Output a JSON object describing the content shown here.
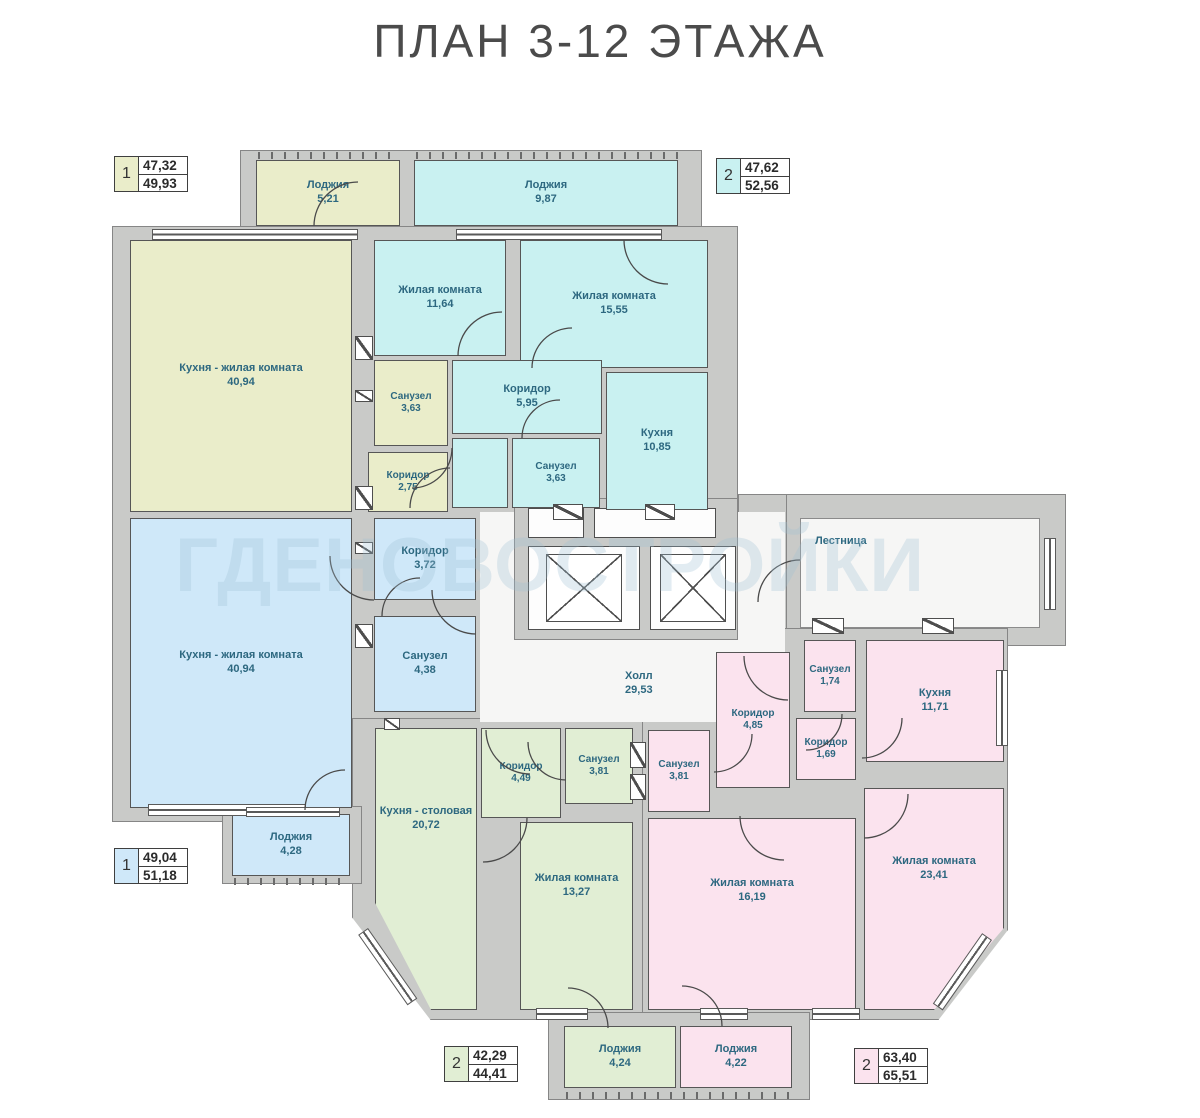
{
  "title": "ПЛАН 3-12 ЭТАЖА",
  "watermark": "ГДЕНОВОСТРОЙКИ",
  "palette": {
    "wall": "#c9cac8",
    "apartment_1_top": "#eaedca",
    "apartment_2_top": "#c9f1f1",
    "apartment_1_bottom": "#cfe8f9",
    "apartment_2_bottom_left": "#e1eed4",
    "apartment_2_bottom_right": "#fbe3ee",
    "room_label": "#2d6880",
    "title_color": "#4b4b4b"
  },
  "badges": [
    {
      "num": "1",
      "area_top": "47,32",
      "area_bottom": "49,93"
    },
    {
      "num": "2",
      "area_top": "47,62",
      "area_bottom": "52,56"
    },
    {
      "num": "1",
      "area_top": "49,04",
      "area_bottom": "51,18"
    },
    {
      "num": "2",
      "area_top": "42,29",
      "area_bottom": "44,41"
    },
    {
      "num": "2",
      "area_top": "63,40",
      "area_bottom": "65,51"
    }
  ],
  "rooms": [
    {
      "name": "Лоджия",
      "area": "5,21"
    },
    {
      "name": "Кухня - жилая комната",
      "area": "40,94"
    },
    {
      "name": "Санузел",
      "area": "3,63"
    },
    {
      "name": "Коридор",
      "area": "2,75"
    },
    {
      "name": "Лоджия",
      "area": "9,87"
    },
    {
      "name": "Жилая комната",
      "area": "11,64"
    },
    {
      "name": "Жилая комната",
      "area": "15,55"
    },
    {
      "name": "Коридор",
      "area": "5,95"
    },
    {
      "name": "Санузел",
      "area": "3,63"
    },
    {
      "name": "Кухня",
      "area": "10,85"
    },
    {
      "name": "Кухня - жилая комната",
      "area": "40,94"
    },
    {
      "name": "Коридор",
      "area": "3,72"
    },
    {
      "name": "Санузел",
      "area": "4,38"
    },
    {
      "name": "Лоджия",
      "area": "4,28"
    },
    {
      "name": "Холл",
      "area": "29,53"
    },
    {
      "name": "Лестница",
      "area": ""
    },
    {
      "name": "Санузел",
      "area": "1,74"
    },
    {
      "name": "Кухня",
      "area": "11,71"
    },
    {
      "name": "Коридор",
      "area": "4,85"
    },
    {
      "name": "Коридор",
      "area": "1,69"
    },
    {
      "name": "Санузел",
      "area": "3,81"
    },
    {
      "name": "Жилая комната",
      "area": "16,19"
    },
    {
      "name": "Жилая комната",
      "area": "23,41"
    },
    {
      "name": "Кухня - столовая",
      "area": "20,72"
    },
    {
      "name": "Коридор",
      "area": "4,49"
    },
    {
      "name": "Санузел",
      "area": "3,81"
    },
    {
      "name": "Жилая комната",
      "area": "13,27"
    },
    {
      "name": "Лоджия",
      "area": "4,24"
    },
    {
      "name": "Лоджия",
      "area": "4,22"
    }
  ]
}
